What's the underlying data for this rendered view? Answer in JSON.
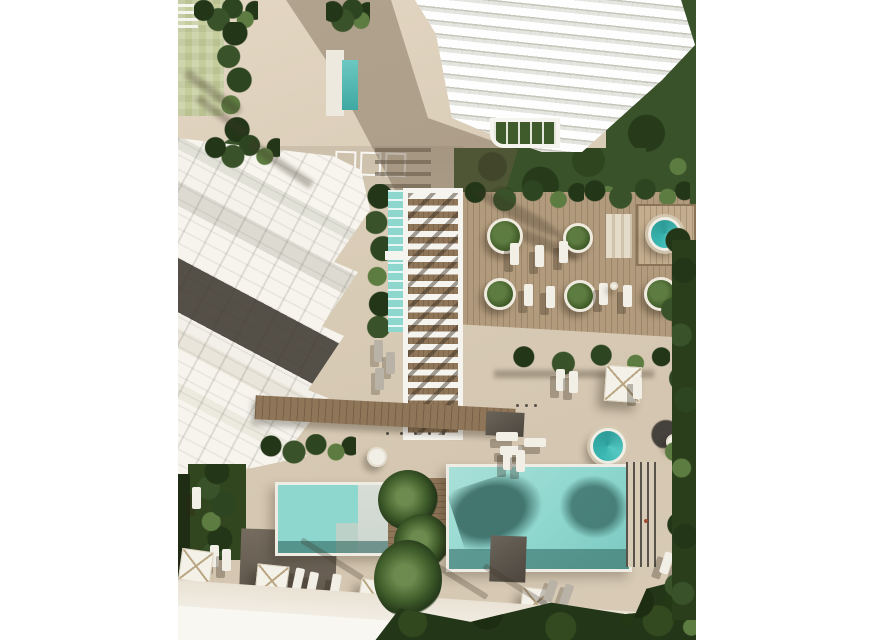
{
  "scene": {
    "type": "aerial-architectural-render",
    "description": "Top-down 3D rendering of a resort-style residential development: a white high-rise tower at top, a low white apartment block at left, a slatted pergola walkway in the center, a timber sun deck with round planters and loungers, a round jacuzzi and spa pool, two turquoise swimming pools at the bottom, white parasols, sun loungers, palm trees and dense green landscaping, framed by white page margins.",
    "objects": [
      "tower-building",
      "left-apartment-building",
      "pergola-walkway",
      "timber-deck",
      "round-planters-x5",
      "jacuzzi-round-pool",
      "spa-round-pool",
      "lap-pool-channel",
      "swimming-pool-left",
      "swimming-pool-right",
      "planter-island-palms",
      "parasols-x5",
      "sun-loungers",
      "hedge-rows",
      "lawns",
      "perimeter-road",
      "swimmer"
    ],
    "counts": {
      "round_planters": 5,
      "square_parasols": 5,
      "round_pools": 2,
      "rect_pools": 2
    }
  },
  "palette": {
    "margin": "#ffffff",
    "plaza": "#dacdb8",
    "road": "#cdc1ac",
    "roadwhite": "#f5f1e9",
    "deck": "#b29b7d",
    "boardwalk": "#8f7659",
    "treedark": "#233618",
    "tree": "#39522a",
    "treelight": "#5d7c41",
    "lawn": "#c6cd9d",
    "pool": "#8ed7cf",
    "pooldark": "#3e7d78",
    "poolpale": "#ccd6d0",
    "spa": "#3ab7b1",
    "bldg": "#f5f3ec",
    "darkrow": "#544f47",
    "patio": "#70665b",
    "charcoal": "#45413c",
    "whiteobj": "#f2efe7",
    "tan": "#bba684",
    "person": "#a04a32"
  }
}
